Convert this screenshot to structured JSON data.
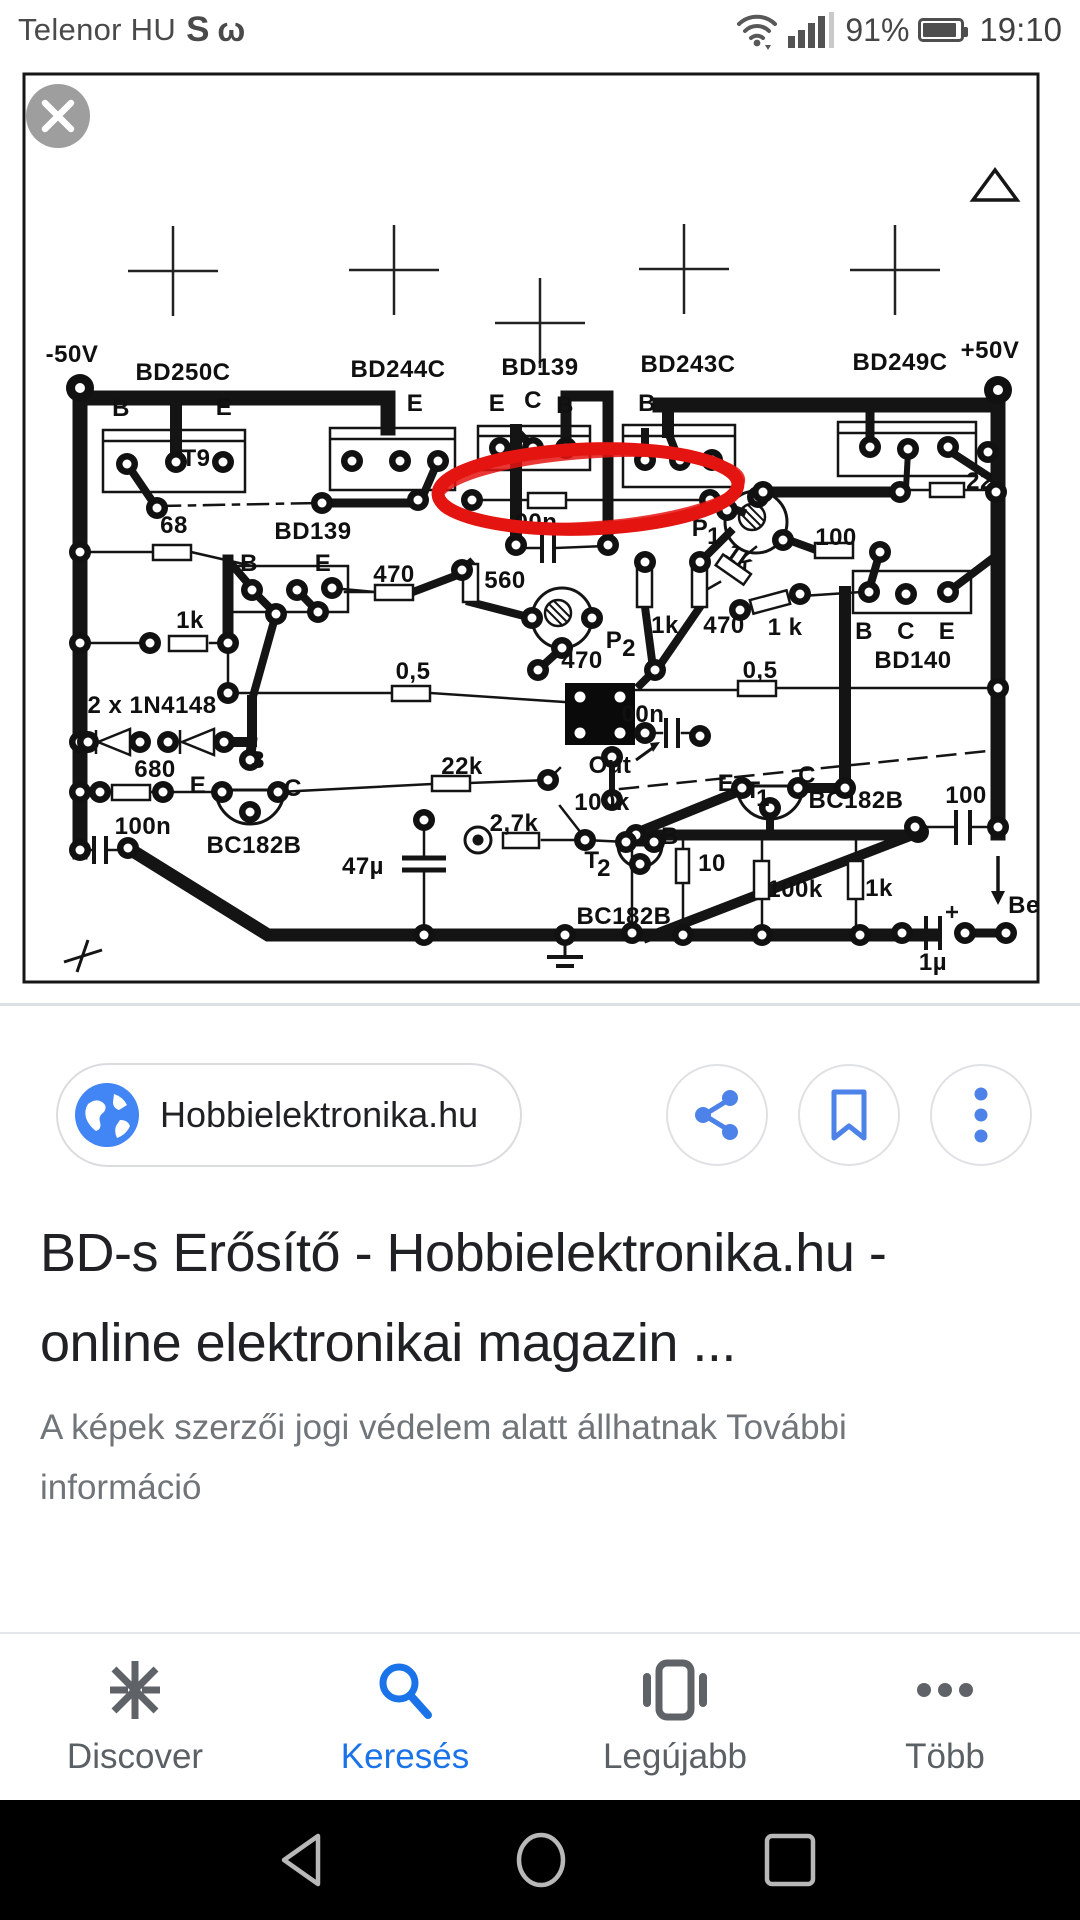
{
  "status_bar": {
    "carrier": "Telenor HU",
    "icon_s": "S",
    "icon_w": "ω",
    "battery_percent": "91%",
    "time": "19:10"
  },
  "image_viewer": {
    "close_icon": "×",
    "annotation_color": "#e41410"
  },
  "pcb": {
    "labels": [
      {
        "t": "-50V",
        "x": 72,
        "y": 362,
        "s": 27
      },
      {
        "t": "BD250C",
        "x": 183,
        "y": 380,
        "s": 27
      },
      {
        "t": "BD244C",
        "x": 398,
        "y": 377,
        "s": 27
      },
      {
        "t": "BD139",
        "x": 540,
        "y": 375,
        "s": 27
      },
      {
        "t": "BD243C",
        "x": 688,
        "y": 372,
        "s": 27
      },
      {
        "t": "BD249C",
        "x": 900,
        "y": 370,
        "s": 27
      },
      {
        "t": "+50V",
        "x": 990,
        "y": 358,
        "s": 27
      },
      {
        "t": "B",
        "x": 121,
        "y": 416
      },
      {
        "t": "E",
        "x": 224,
        "y": 415
      },
      {
        "t": "E",
        "x": 415,
        "y": 411
      },
      {
        "t": "E",
        "x": 497,
        "y": 411
      },
      {
        "t": "C",
        "x": 533,
        "y": 408
      },
      {
        "t": "B",
        "x": 565,
        "y": 413
      },
      {
        "t": "B",
        "x": 647,
        "y": 411
      },
      {
        "t": "T9",
        "x": 196,
        "y": 466,
        "s": 25
      },
      {
        "t": "68",
        "x": 174,
        "y": 533
      },
      {
        "t": "BD139",
        "x": 313,
        "y": 539,
        "s": 26
      },
      {
        "t": "B",
        "x": 249,
        "y": 571
      },
      {
        "t": "E",
        "x": 323,
        "y": 571
      },
      {
        "t": "470",
        "x": 394,
        "y": 582
      },
      {
        "t": "560",
        "x": 505,
        "y": 588
      },
      {
        "t": "1k",
        "x": 190,
        "y": 628
      },
      {
        "t": "0,5",
        "x": 413,
        "y": 679
      },
      {
        "t": "2 x 1N4148",
        "x": 152,
        "y": 713
      },
      {
        "t": "680",
        "x": 155,
        "y": 777
      },
      {
        "t": "100n",
        "x": 143,
        "y": 834
      },
      {
        "t": "BC182B",
        "x": 254,
        "y": 853,
        "s": 26
      },
      {
        "t": "E",
        "x": 198,
        "y": 793
      },
      {
        "t": "C",
        "x": 293,
        "y": 796
      },
      {
        "t": "3",
        "x": 258,
        "y": 768
      },
      {
        "t": "22k",
        "x": 462,
        "y": 774
      },
      {
        "t": "100k",
        "x": 602,
        "y": 810
      },
      {
        "t": "2,7k",
        "x": 514,
        "y": 831
      },
      {
        "t": "47µ",
        "x": 363,
        "y": 874
      },
      {
        "t": "Out",
        "x": 610,
        "y": 773,
        "s": 26
      },
      {
        "t": "00n",
        "x": 536,
        "y": 530
      },
      {
        "t": "00n",
        "x": 643,
        "y": 722
      },
      {
        "t": "470",
        "x": 582,
        "y": 668
      },
      {
        "t": "P",
        "x": 614,
        "y": 648,
        "s": 26
      },
      {
        "t": "2",
        "x": 629,
        "y": 656,
        "s": 18
      },
      {
        "t": "P",
        "x": 700,
        "y": 536,
        "s": 26
      },
      {
        "t": "1",
        "x": 714,
        "y": 544,
        "s": 18
      },
      {
        "t": "1k",
        "x": 735,
        "y": 564,
        "r": 35
      },
      {
        "t": "1k",
        "x": 665,
        "y": 633
      },
      {
        "t": "470",
        "x": 724,
        "y": 633
      },
      {
        "t": "1 k",
        "x": 785,
        "y": 635
      },
      {
        "t": "0,5",
        "x": 760,
        "y": 678
      },
      {
        "t": "100",
        "x": 836,
        "y": 545
      },
      {
        "t": "B",
        "x": 864,
        "y": 639
      },
      {
        "t": "C",
        "x": 906,
        "y": 639
      },
      {
        "t": "E",
        "x": 947,
        "y": 639
      },
      {
        "t": "BD140",
        "x": 913,
        "y": 668,
        "s": 26
      },
      {
        "t": "22",
        "x": 980,
        "y": 489
      },
      {
        "t": "E",
        "x": 726,
        "y": 791
      },
      {
        "t": "T",
        "x": 753,
        "y": 798,
        "s": 23
      },
      {
        "t": "1",
        "x": 763,
        "y": 806,
        "s": 16
      },
      {
        "t": "C",
        "x": 807,
        "y": 783
      },
      {
        "t": "BC182B",
        "x": 856,
        "y": 808,
        "s": 26
      },
      {
        "t": "100",
        "x": 966,
        "y": 803
      },
      {
        "t": "10",
        "x": 712,
        "y": 871
      },
      {
        "t": "B",
        "x": 670,
        "y": 844
      },
      {
        "t": "T",
        "x": 592,
        "y": 868,
        "s": 23
      },
      {
        "t": "2",
        "x": 604,
        "y": 876,
        "s": 18
      },
      {
        "t": "BC182B",
        "x": 624,
        "y": 924,
        "s": 26
      },
      {
        "t": "100k",
        "x": 795,
        "y": 897
      },
      {
        "t": "1k",
        "x": 879,
        "y": 896
      },
      {
        "t": "Be",
        "x": 1024,
        "y": 913,
        "s": 26
      },
      {
        "t": "1µ",
        "x": 933,
        "y": 970
      }
    ]
  },
  "source_chip": {
    "site": "Hobbielektronika.hu"
  },
  "result": {
    "title_lines": [
      "BD-s Erősítő - Hobbielektronika.hu -",
      "online elektronikai magazin ..."
    ],
    "snippet_lines": [
      "A képek szerzői jogi védelem alatt állhatnak További",
      "információ"
    ]
  },
  "bottom_nav": {
    "items": [
      {
        "label": "Discover"
      },
      {
        "label": "Keresés"
      },
      {
        "label": "Legújabb"
      },
      {
        "label": "Több"
      }
    ]
  }
}
